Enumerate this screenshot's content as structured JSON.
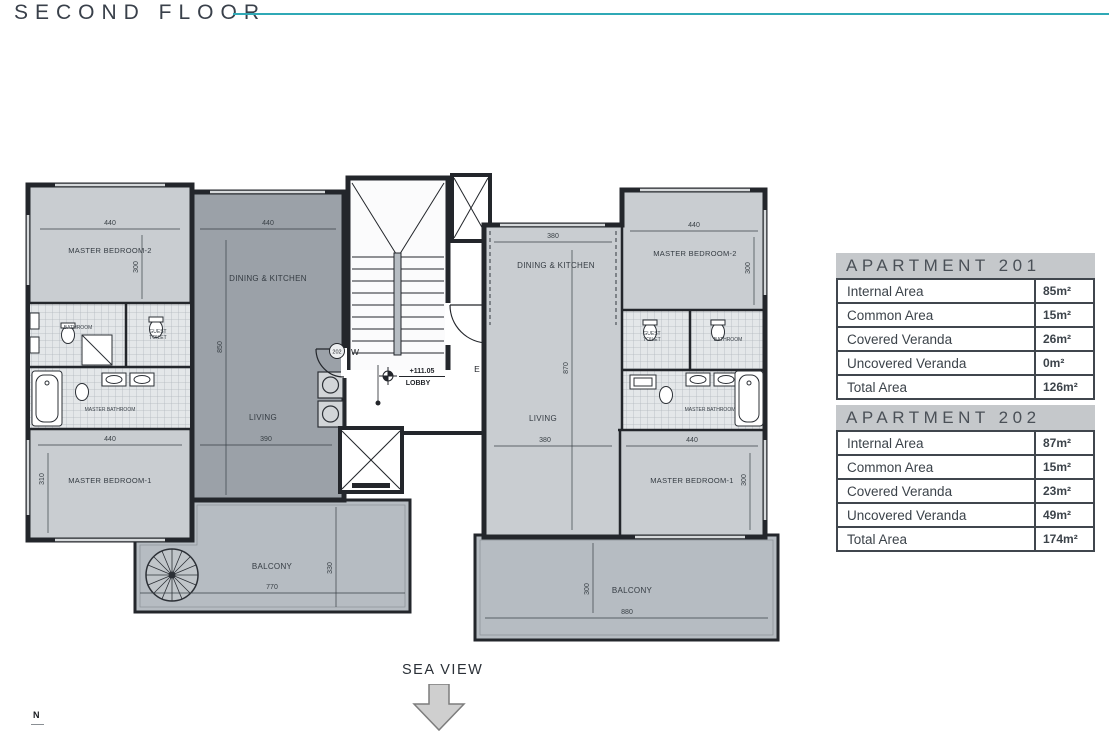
{
  "header": {
    "title": "SECOND FLOOR"
  },
  "footer": {
    "sea_view": "SEA VIEW",
    "north": "N"
  },
  "colors": {
    "accent": "#2fa9b6",
    "wall": "#23262b",
    "room_light": "#c9cdd1",
    "room_dark": "#9ba1a8",
    "balcony": "#b6bcc2",
    "table_border": "#40464d",
    "table_header_bg": "#c5c8cb"
  },
  "plan": {
    "lobby": {
      "level": "+111.05",
      "label": "LOBBY"
    },
    "doors": {
      "west": {
        "unit": "202",
        "letter": "W"
      },
      "east": {
        "unit": "201",
        "letter": "E"
      }
    },
    "apt202": {
      "master_bedroom_2": {
        "label": "MASTER BEDROOM-2",
        "w": "440",
        "h": "300"
      },
      "dining_kitchen": {
        "label": "DINING & KITCHEN",
        "w": "440",
        "h": "850"
      },
      "bathroom": {
        "label": "BATHROOM"
      },
      "guest_toilet": {
        "line1": "GUEST",
        "line2": "TOILET"
      },
      "master_bathroom": {
        "label": "MASTER BATHROOM"
      },
      "master_bedroom_1": {
        "label": "MASTER BEDROOM-1",
        "w": "440",
        "h": "310"
      },
      "living": {
        "label": "LIVING",
        "w": "390"
      },
      "balcony": {
        "label": "BALCONY",
        "w": "770",
        "h": "330"
      }
    },
    "apt201": {
      "dining_kitchen": {
        "label": "DINING & KITCHEN",
        "w": "380",
        "h": "870"
      },
      "master_bedroom_2": {
        "label": "MASTER BEDROOM-2",
        "w": "440",
        "h": "300"
      },
      "guest_toilet": {
        "line1": "GUEST",
        "line2": "TOILET"
      },
      "bathroom": {
        "label": "BATHROOM"
      },
      "master_bathroom": {
        "label": "MASTER BATHROOM"
      },
      "master_bedroom_1": {
        "label": "MASTER BEDROOM-1",
        "w": "440",
        "h": "300"
      },
      "living": {
        "label": "LIVING",
        "w": "380"
      },
      "balcony": {
        "label": "BALCONY",
        "w": "880",
        "h": "300"
      }
    }
  },
  "tables": {
    "apt201": {
      "title": "APARTMENT 201",
      "rows": [
        {
          "label": "Internal Area",
          "value": "85m²"
        },
        {
          "label": "Common Area",
          "value": "15m²"
        },
        {
          "label": "Covered Veranda",
          "value": "26m²"
        },
        {
          "label": "Uncovered Veranda",
          "value": "0m²"
        },
        {
          "label": "Total Area",
          "value": "126m²"
        }
      ]
    },
    "apt202": {
      "title": "APARTMENT 202",
      "rows": [
        {
          "label": "Internal Area",
          "value": "87m²"
        },
        {
          "label": "Common Area",
          "value": "15m²"
        },
        {
          "label": "Covered Veranda",
          "value": "23m²"
        },
        {
          "label": "Uncovered Veranda",
          "value": "49m²"
        },
        {
          "label": "Total Area",
          "value": "174m²"
        }
      ]
    }
  }
}
